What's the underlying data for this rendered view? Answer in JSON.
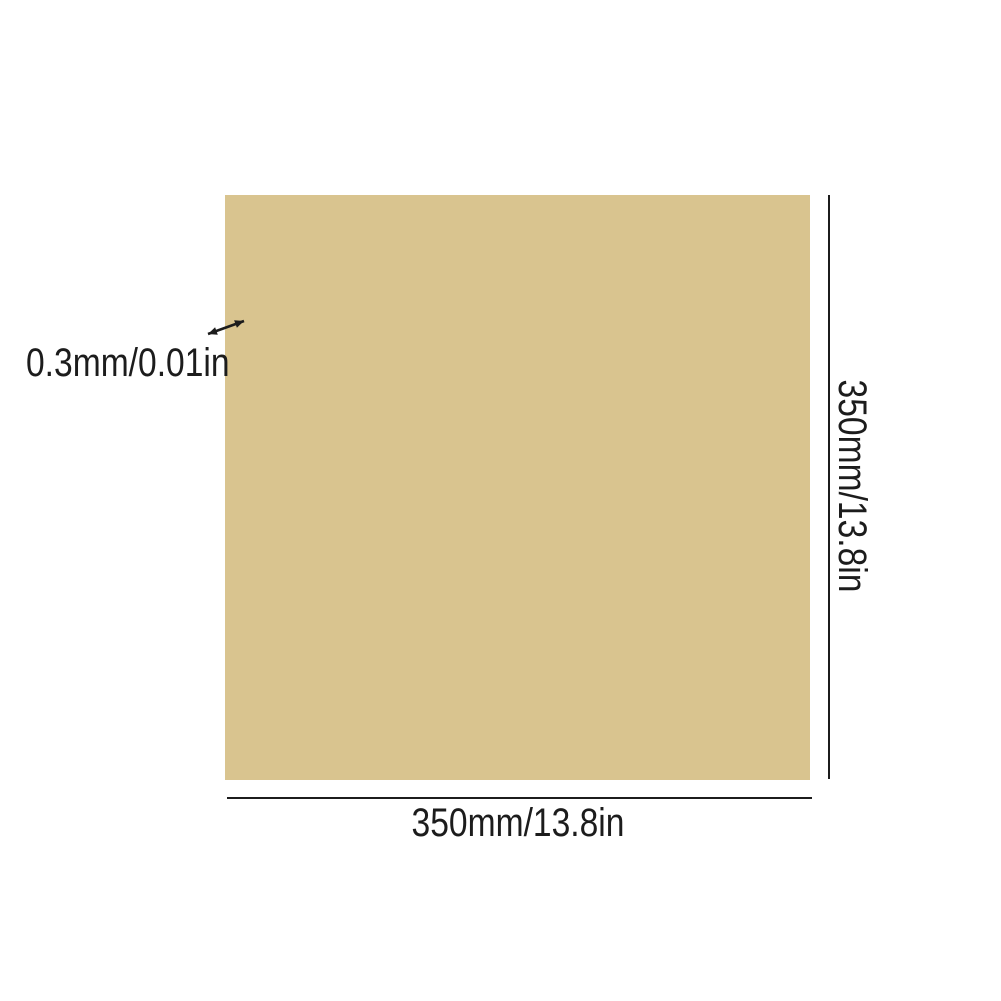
{
  "page": {
    "background_color": "#ffffff"
  },
  "diagram": {
    "sheet_color": "#d9c48f",
    "line_color": "#1c1c1c",
    "thickness_label": "0.3mm/0.01in",
    "height_label": "350mm/13.8in",
    "width_label": "350mm/13.8in"
  }
}
